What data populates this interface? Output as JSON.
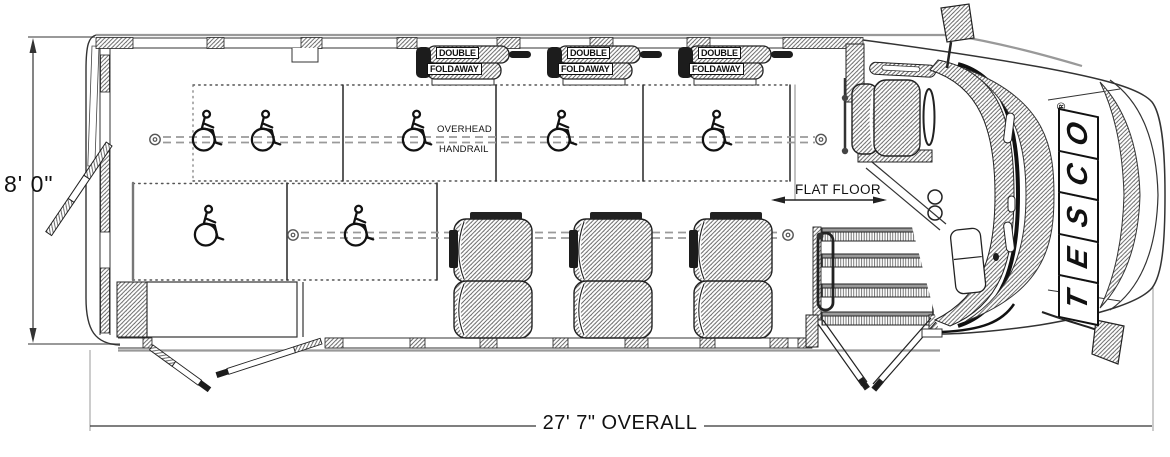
{
  "colors": {
    "line": "#222222",
    "hatch_line": "#5a5a5a",
    "soft_line": "#999999",
    "dark_fill": "#1c1c1c",
    "track": "#9a9a9a",
    "background": "#ffffff"
  },
  "dimensions": {
    "height": "8' 0\"",
    "length": "27' 7\" OVERALL"
  },
  "annotations": {
    "flat_floor": "FLAT FLOOR",
    "overhead_line1": "OVERHEAD",
    "overhead_line2": "HANDRAIL"
  },
  "foldaway_seats": [
    {
      "line1": "DOUBLE",
      "line2": "FOLDAWAY"
    },
    {
      "line1": "DOUBLE",
      "line2": "FOLDAWAY"
    },
    {
      "line1": "DOUBLE",
      "line2": "FOLDAWAY"
    }
  ],
  "brand": {
    "name": "TESCO",
    "registered": "®"
  }
}
